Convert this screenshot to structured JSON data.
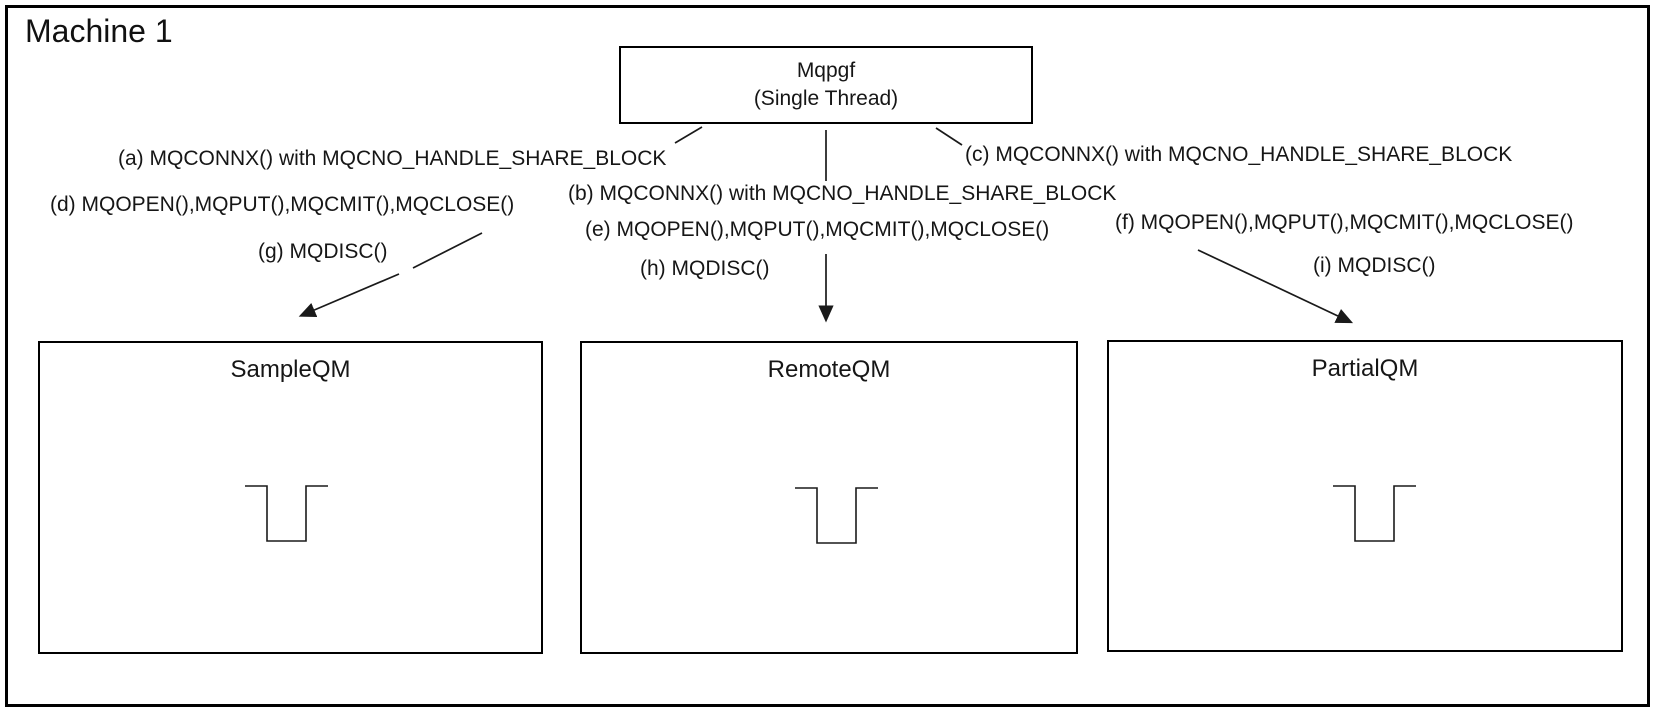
{
  "page_title": "Machine 1",
  "accent_color": "#000000",
  "producer_box": {
    "line1": "Mqpgf",
    "line2": "(Single Thread)"
  },
  "call_labels": {
    "a": "(a) MQCONNX() with MQCNO_HANDLE_SHARE_BLOCK",
    "b": "(b) MQCONNX() with MQCNO_HANDLE_SHARE_BLOCK",
    "c": "(c) MQCONNX() with MQCNO_HANDLE_SHARE_BLOCK",
    "d": "(d) MQOPEN(),MQPUT(),MQCMIT(),MQCLOSE()",
    "e": "(e) MQOPEN(),MQPUT(),MQCMIT(),MQCLOSE()",
    "f": "(f) MQOPEN(),MQPUT(),MQCMIT(),MQCLOSE()",
    "g": "(g) MQDISC()",
    "h": "(h) MQDISC()",
    "i": "(i) MQDISC()"
  },
  "queue_managers": [
    {
      "name": "SampleQM",
      "icon": "queue-icon"
    },
    {
      "name": "RemoteQM",
      "icon": "queue-icon"
    },
    {
      "name": "PartialQM",
      "icon": "queue-icon"
    }
  ]
}
